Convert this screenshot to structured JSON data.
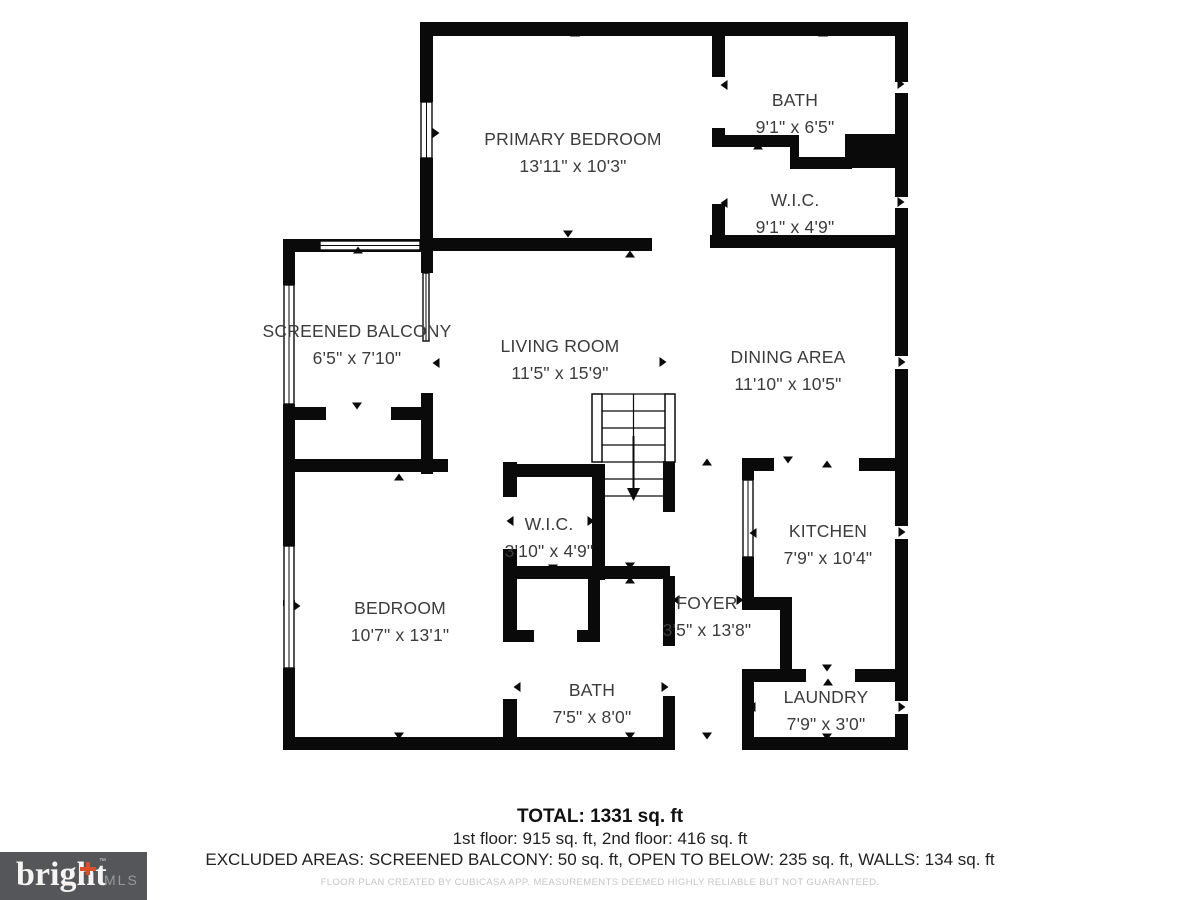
{
  "floorplan": {
    "rooms": [
      {
        "name": "PRIMARY BEDROOM",
        "dims": "13'11\" x 10'3\""
      },
      {
        "name": "BATH",
        "dims": "9'1\" x 6'5\""
      },
      {
        "name": "W.I.C.",
        "dims": "9'1\" x 4'9\""
      },
      {
        "name": "SCREENED BALCONY",
        "dims": "6'5\" x 7'10\""
      },
      {
        "name": "LIVING ROOM",
        "dims": "11'5\" x 15'9\""
      },
      {
        "name": "DINING AREA",
        "dims": "11'10\" x 10'5\""
      },
      {
        "name": "W.I.C.",
        "dims": "3'10\" x 4'9\""
      },
      {
        "name": "KITCHEN",
        "dims": "7'9\" x 10'4\""
      },
      {
        "name": "BEDROOM",
        "dims": "10'7\" x 13'1\""
      },
      {
        "name": "FOYER",
        "dims": "3'5\" x 13'8\""
      },
      {
        "name": "BATH",
        "dims": "7'5\" x 8'0\""
      },
      {
        "name": "LAUNDRY",
        "dims": "7'9\" x 3'0\""
      }
    ]
  },
  "summary": {
    "total": "TOTAL: 1331 sq. ft",
    "floors": "1st floor: 915 sq. ft, 2nd floor: 416 sq. ft",
    "excluded": "EXCLUDED AREAS: SCREENED BALCONY: 50 sq. ft, OPEN TO BELOW: 235 sq. ft, WALLS: 134 sq. ft",
    "disclaimer": "FLOOR PLAN CREATED BY CUBICASA APP. MEASUREMENTS DEEMED HIGHLY RELIABLE BUT NOT GUARANTEED."
  },
  "branding": {
    "logo_word": "bright",
    "logo_suffix": "MLS",
    "trademark": "™"
  },
  "colors": {
    "wall": "#0a0a0a",
    "label_text": "#3c3c3c",
    "logo_bg": "#55565a",
    "logo_accent": "#d94f2b",
    "disclaimer_text": "#c6c6c6"
  }
}
